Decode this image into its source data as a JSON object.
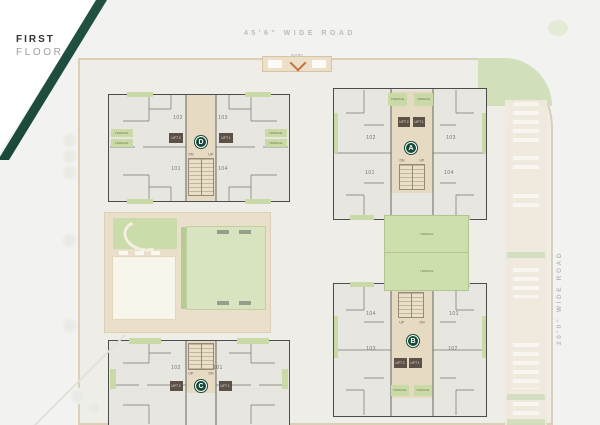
{
  "title": {
    "line1": "FIRST",
    "line2": "FLOOR"
  },
  "roads": {
    "top": "45'6\" WIDE ROAD",
    "right": "20'0\" WIDE ROAD"
  },
  "entry": {
    "label": "ENTRY"
  },
  "terrace_label": "TERRACE",
  "garden_terraces": [
    "TERRACE",
    "TERRACE"
  ],
  "blocks": {
    "A": {
      "letter": "A",
      "units": {
        "tl": "102",
        "tr": "103",
        "bl": "101",
        "br": "104"
      },
      "lifts": {
        "left": "LIFT 2",
        "right": "LIFT 1"
      },
      "stairs": {
        "left": "DN",
        "right": "UP"
      }
    },
    "B": {
      "letter": "B",
      "units": {
        "tl": "104",
        "tr": "101",
        "bl": "103",
        "br": "102"
      },
      "lifts": {
        "left": "LIFT 2",
        "right": "LIFT 1"
      },
      "stairs": {
        "left": "UP",
        "right": "DN"
      }
    },
    "C": {
      "letter": "C",
      "units": {
        "l": "102",
        "r": "101"
      },
      "lifts": {
        "left": "LIFT 2",
        "right": "LIFT 1"
      },
      "stairs": {
        "left": "UP",
        "right": "DN"
      }
    },
    "D": {
      "letter": "D",
      "units": {
        "tl": "102",
        "tr": "103",
        "bl": "101",
        "br": "104"
      },
      "lifts": {
        "left": "LIFT 2",
        "right": "LIFT 1"
      },
      "stairs": {
        "left": "DN",
        "right": "UP"
      }
    }
  },
  "colors": {
    "accent_green": "#174936",
    "terrace_green": "#c9daa6",
    "lawn_green": "#d8e4c0",
    "core_beige": "#e6dac3",
    "lift_dark": "#5c5146",
    "entry_arrow": "#c2743c"
  }
}
